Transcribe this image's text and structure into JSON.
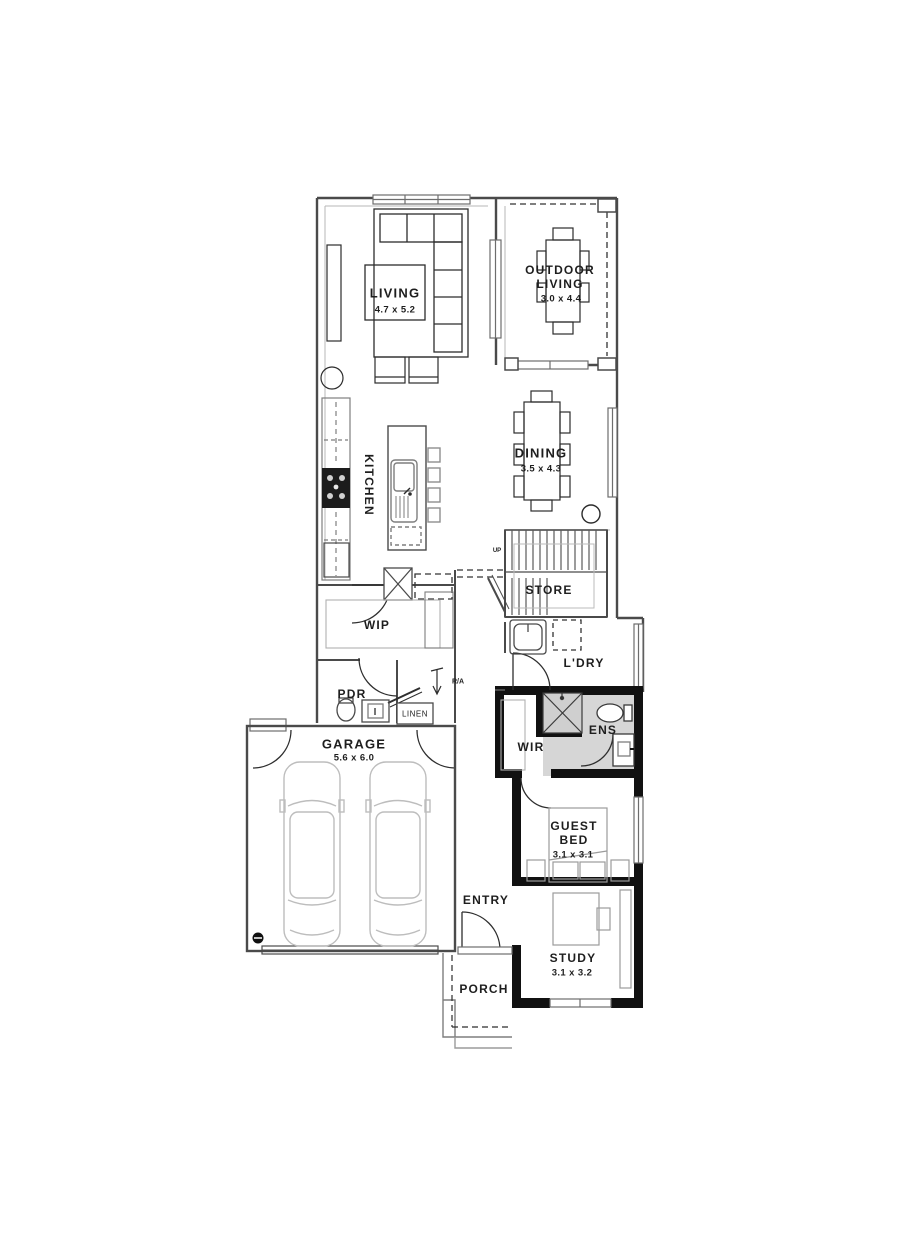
{
  "plan_title": "Ground floor plan",
  "rooms": {
    "living": {
      "name": "LIVING",
      "dims": "4.7 x 5.2"
    },
    "outdoor_living": {
      "name_line1": "OUTDOOR",
      "name_line2": "LIVING",
      "dims": "3.0 x 4.4"
    },
    "kitchen": {
      "name": "KITCHEN"
    },
    "dining": {
      "name": "DINING",
      "dims": "3.5 x 4.3"
    },
    "stairs": {
      "direction_label": "UP"
    },
    "store": {
      "name": "STORE"
    },
    "wip": {
      "name": "WIP"
    },
    "laundry": {
      "name": "L'DRY"
    },
    "powder": {
      "name": "PDR"
    },
    "linen": {
      "name": "LINEN"
    },
    "return_air": {
      "name": "R/A"
    },
    "garage": {
      "name": "GARAGE",
      "dims": "5.6 x 6.0"
    },
    "wir": {
      "name": "WIR"
    },
    "ensuite": {
      "name": "ENS"
    },
    "guest_bed": {
      "name_line1": "GUEST",
      "name_line2": "BED",
      "dims": "3.1 x 3.1"
    },
    "entry": {
      "name": "ENTRY"
    },
    "study": {
      "name": "STUDY",
      "dims": "3.1 x 3.2"
    },
    "porch": {
      "name": "PORCH"
    }
  },
  "colors": {
    "wall_thin": "#4a4a4a",
    "wall_black": "#111111",
    "ensuite_fill": "#d6d6d6",
    "furniture_dark": "#2c2c2c",
    "furniture_light": "#9b9b9b",
    "car_line": "#bdbdbd"
  }
}
